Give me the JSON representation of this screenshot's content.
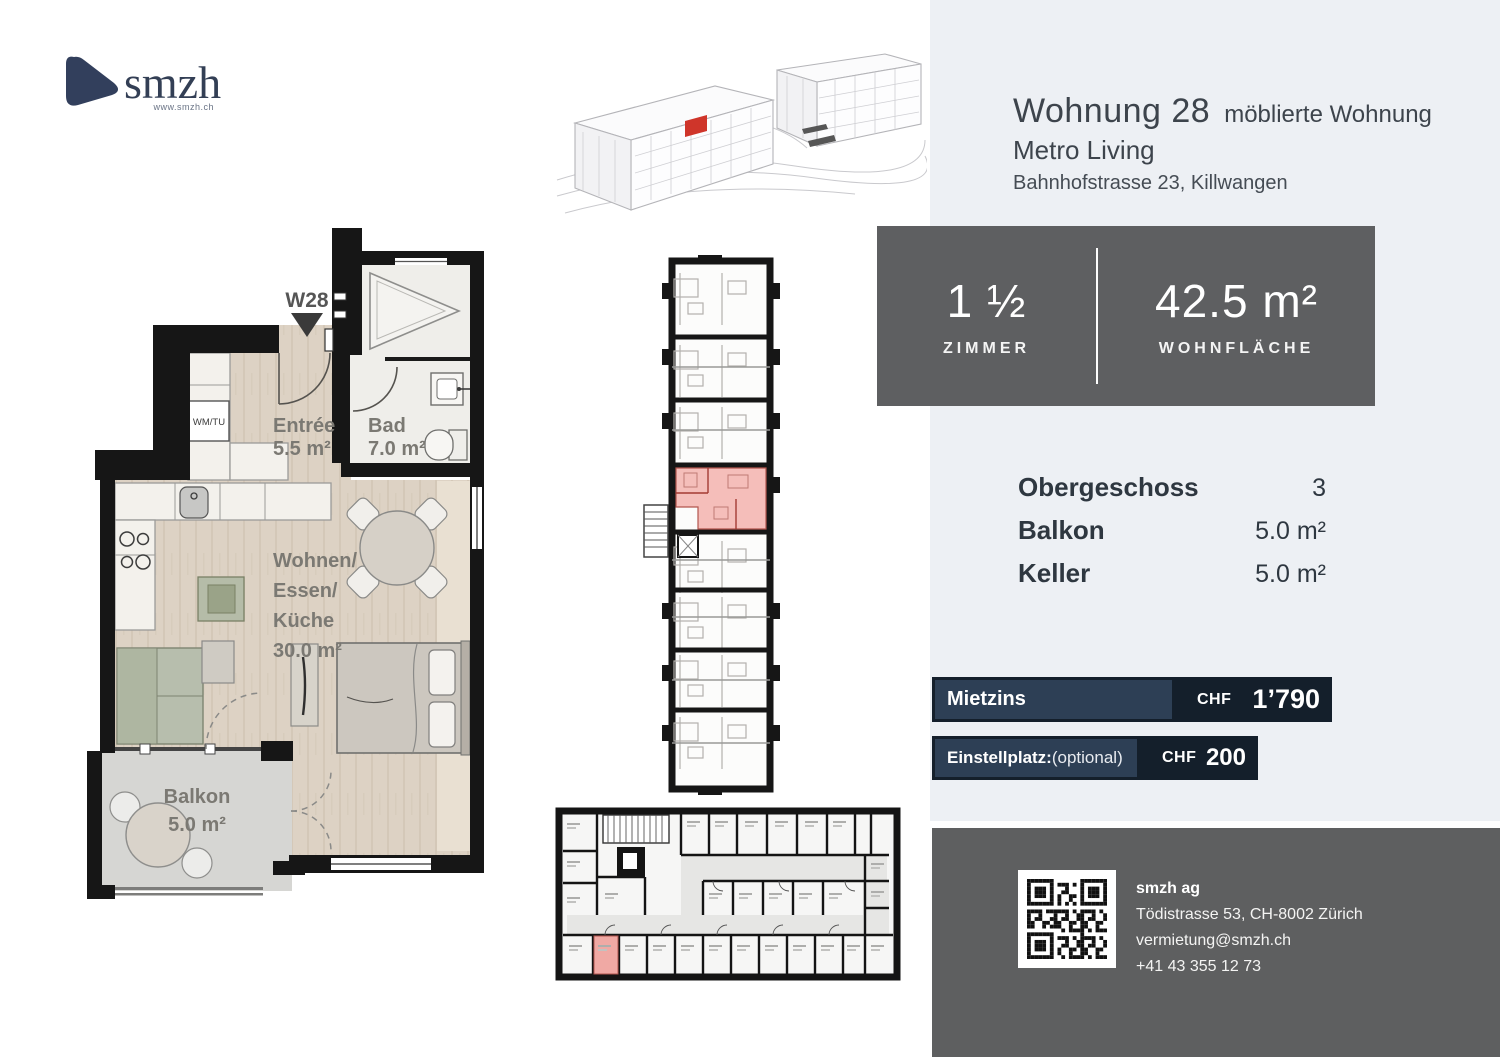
{
  "logo": {
    "name": "smzh",
    "url": "www.smzh.ch"
  },
  "header": {
    "title": "Wohnung 28",
    "subtitle": "möblierte Wohnung",
    "project": "Metro Living",
    "address": "Bahnhofstrasse 23, Killwangen"
  },
  "stats": {
    "rooms_value": "1 ½",
    "rooms_label": "ZIMMER",
    "area_value": "42.5 m²",
    "area_label": "WOHNFLÄCHE"
  },
  "details": [
    {
      "label": "Obergeschoss",
      "value": "3"
    },
    {
      "label": "Balkon",
      "value": "5.0 m²"
    },
    {
      "label": "Keller",
      "value": "5.0 m²"
    }
  ],
  "pricing": {
    "rent_label": "Mietzins",
    "rent_currency": "CHF",
    "rent_value": "1’790",
    "parking_label": "Einstellplatz:",
    "parking_note": "(optional)",
    "parking_currency": "CHF",
    "parking_value": "200"
  },
  "plan": {
    "marker": "W28",
    "entree_name": "Entrée",
    "entree_area": "5.5 m²",
    "bad_name": "Bad",
    "bad_area": "7.0 m²",
    "wohnen_line1": "Wohnen/",
    "wohnen_line2": "Essen/",
    "wohnen_line3": "Küche",
    "wohnen_area": "30.0 m²",
    "balkon_name": "Balkon",
    "balkon_area": "5.0 m²",
    "wm_label": "WM/TU"
  },
  "footer": {
    "company": "smzh ag",
    "address": "Tödistrasse 53, CH-8002 Zürich",
    "email": "vermietung@smzh.ch",
    "phone": "+41 43 355 12 73"
  },
  "colors": {
    "highlight_red": "#cf352a",
    "unit_pink": "#f4b9b4",
    "navy": "#2d3f55",
    "dark_navy": "#141f2b",
    "box_gray": "#5e5f61",
    "panel_gray": "#edf0f4"
  }
}
